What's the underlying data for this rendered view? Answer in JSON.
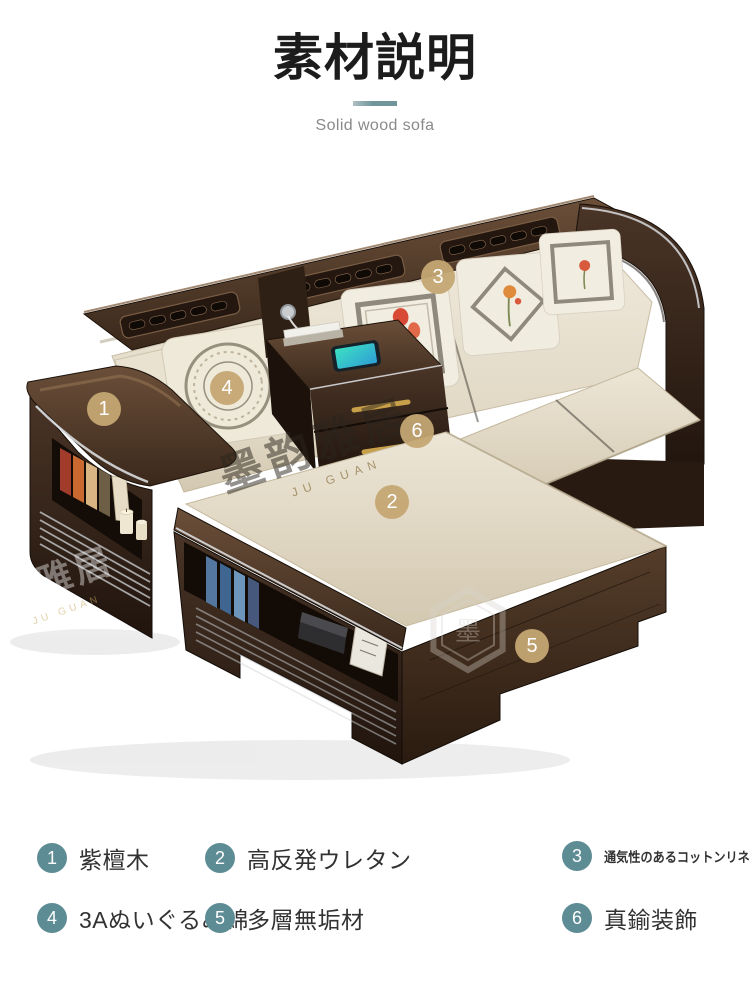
{
  "header": {
    "title": "素材説明",
    "subtitle": "Solid wood sofa"
  },
  "colors": {
    "accent_teal": "#5d8c95",
    "divider_teal": "#6f959b",
    "callout_gold": "#c4a773",
    "wood_dark": "#38281e",
    "fabric_cream": "#eae2d2",
    "brass": "#c9a04a",
    "chrome": "#d9dcdf"
  },
  "sofa": {
    "callouts": [
      {
        "number": "1"
      },
      {
        "number": "2"
      },
      {
        "number": "3"
      },
      {
        "number": "4"
      },
      {
        "number": "5"
      },
      {
        "number": "6"
      }
    ],
    "watermark": {
      "text": "墨韵雅居",
      "latin": "JU GUAN",
      "side_text": "韵雅居",
      "logo_char": "墨"
    }
  },
  "legend": {
    "items": [
      {
        "number": "1",
        "label": "紫檀木"
      },
      {
        "number": "2",
        "label": "高反発ウレタン"
      },
      {
        "number": "3",
        "label": "通気性のあるコットンリネン"
      },
      {
        "number": "4",
        "label": "3Aぬいぐるみ綿"
      },
      {
        "number": "5",
        "label": "多層無垢材"
      },
      {
        "number": "6",
        "label": "真鍮装飾"
      }
    ]
  }
}
